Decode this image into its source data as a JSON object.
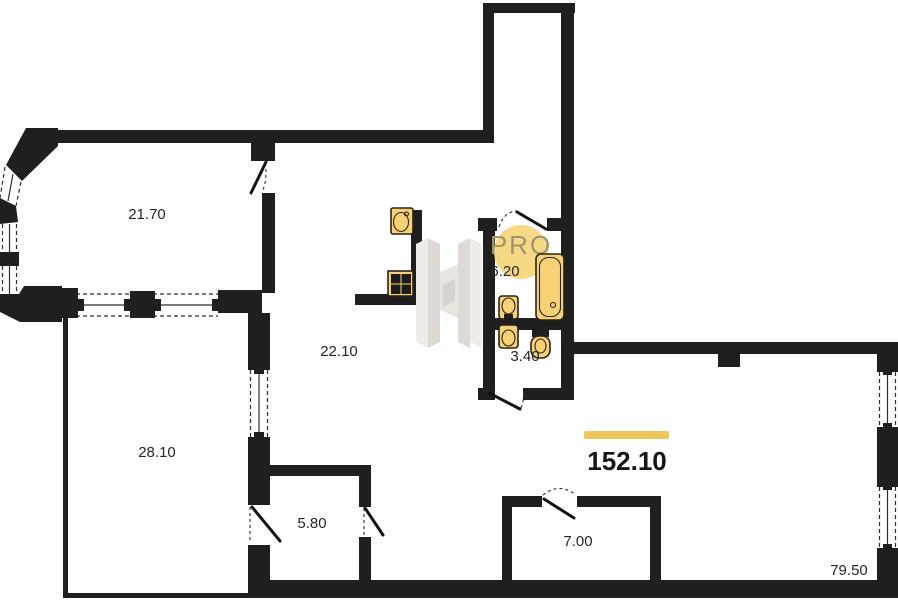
{
  "plan": {
    "badge": {
      "label": "PRO"
    },
    "total": {
      "value": "152.10"
    },
    "rooms": {
      "bay_living": {
        "area": "21.70"
      },
      "kitchen_hall": {
        "area": "22.10"
      },
      "bedroom": {
        "area": "28.10"
      },
      "bathroom": {
        "area": "6.20"
      },
      "wc": {
        "area": "3.40"
      },
      "storage": {
        "area": "5.80"
      },
      "inner_room": {
        "area": "7.00"
      },
      "living_area": {
        "area": "79.50"
      }
    },
    "colors": {
      "wall": "#1f1f1f",
      "fixture_fill": "#F8D177",
      "accent_bar": "#EEC65C",
      "badge_fill": "#F6D77D",
      "badge_text": "#A2936F",
      "watermark_light": "#EFECE9",
      "watermark_mid": "#E3DFDA",
      "watermark_dark": "#D8D3CE"
    }
  }
}
